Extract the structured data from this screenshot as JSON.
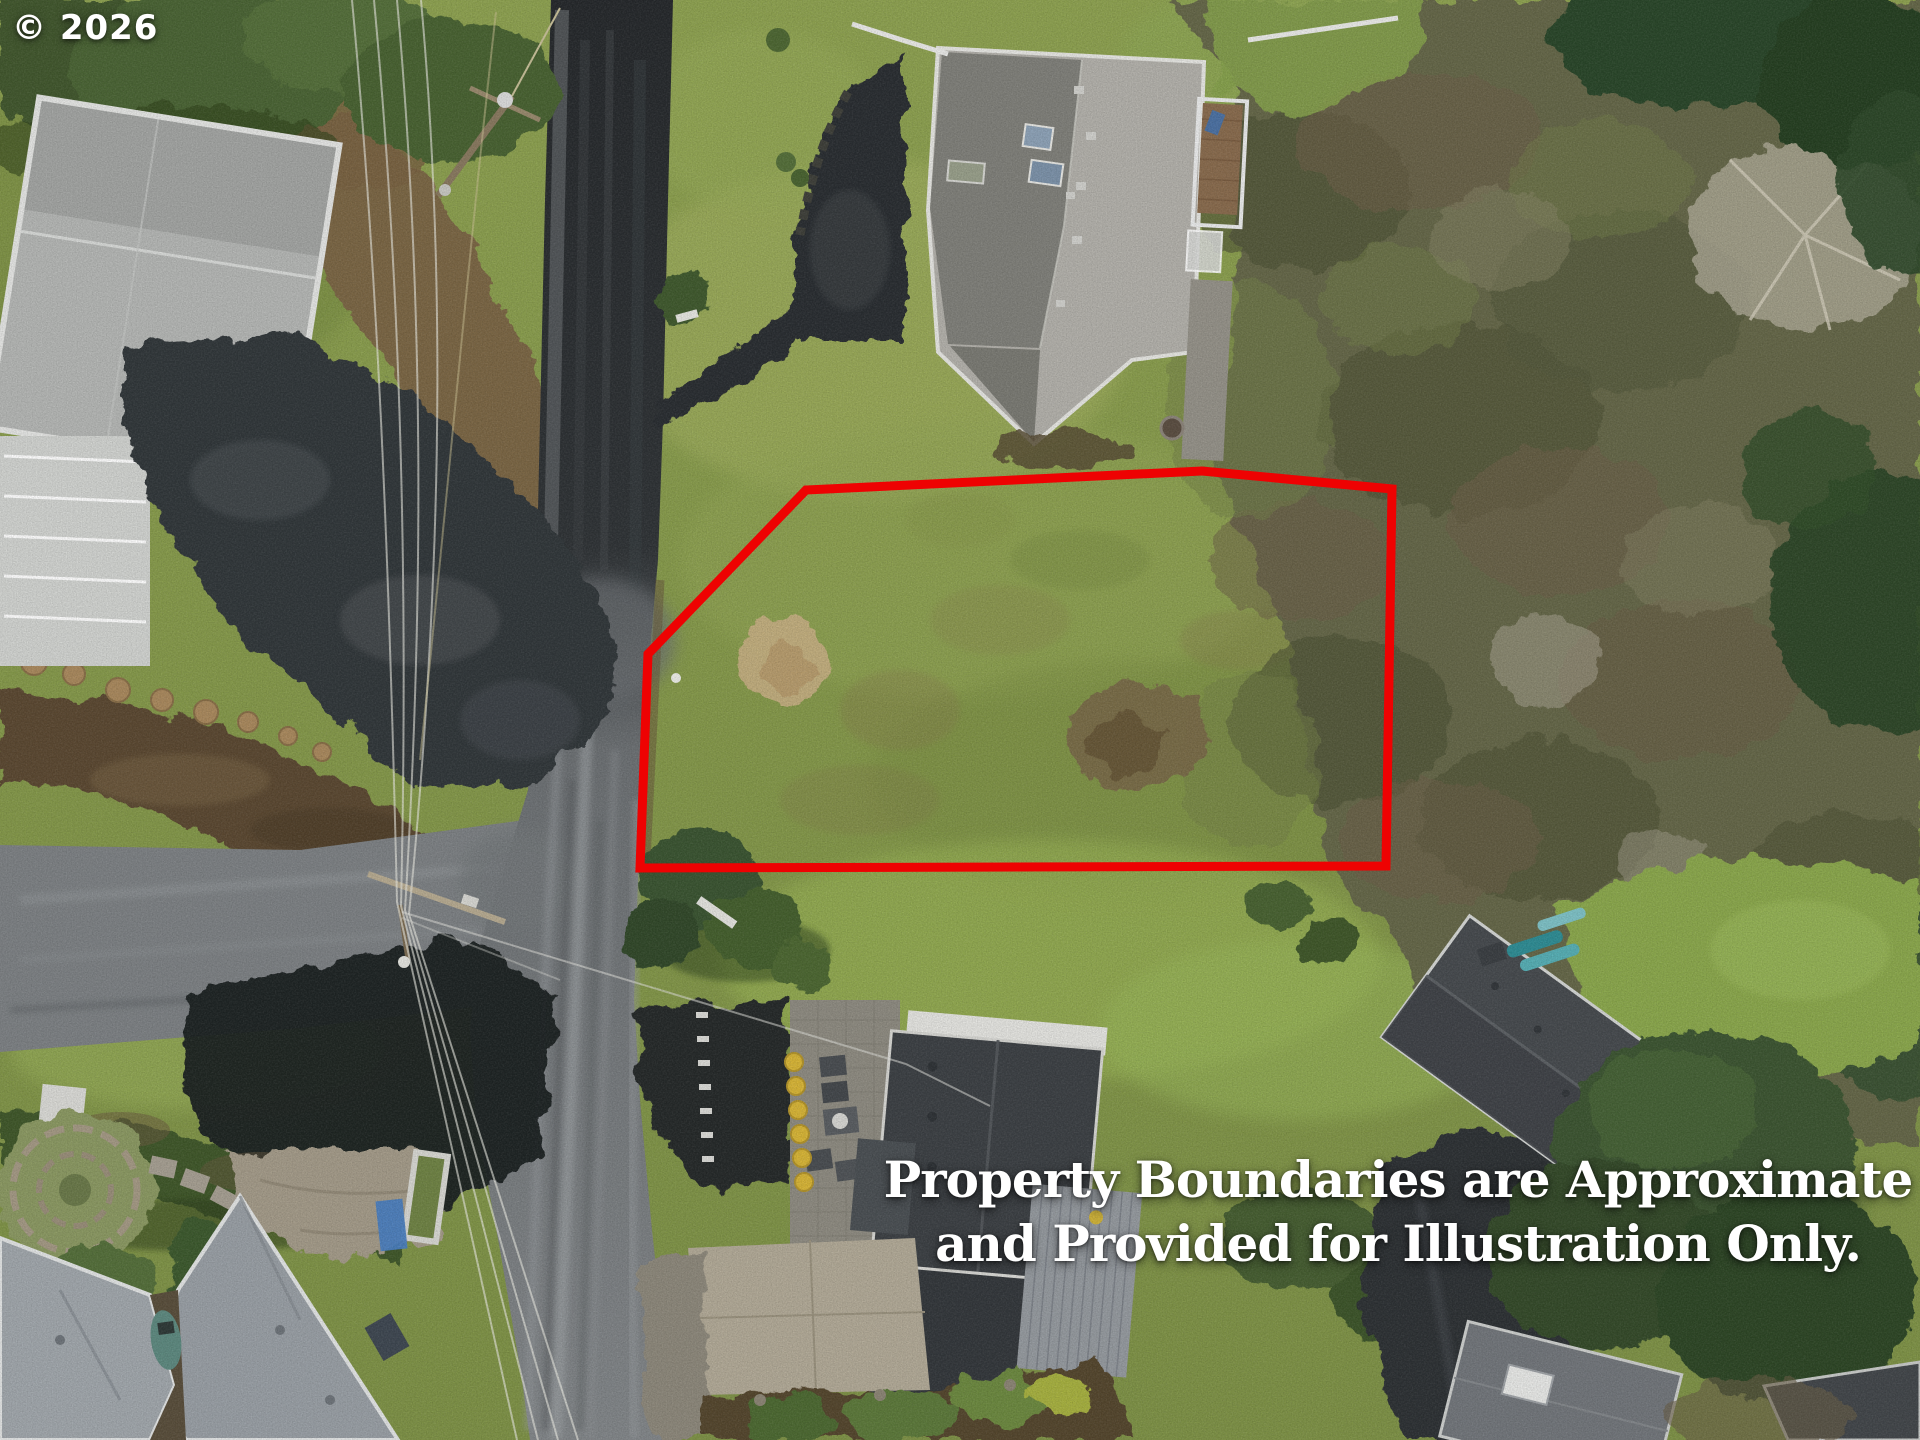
{
  "watermark": {
    "text": "© 2026"
  },
  "disclaimer": {
    "line1": "Property Boundaries are Approximate",
    "line2": "and Provided for Illustration Only."
  },
  "boundary": {
    "points_attr": "648,654 806,490 1202,471 1392,489 1386,866 640,868",
    "stroke_width": "9"
  },
  "colors": {
    "boundary_red": "#ee0202",
    "text_white": "#ffffff",
    "grass_base": "#8da24f",
    "road_fresh": "#2c2f32",
    "road_old": "#7d8184",
    "road_patch": "#1d2023",
    "roof_light": "#b6b8b6",
    "roof_mid": "#b4b2ac",
    "roof_dark": "#3d4145",
    "roof_bluegray": "#9aa0a6",
    "concrete": "#b3ab98",
    "dirt_brown": "#7b6544",
    "scrub_olive": "#66684a",
    "conifer_green": "#344c2b",
    "deck_wood": "#8a6c4e",
    "pot_yellow": "#d9b637",
    "tarp_blue": "#4a7fc1",
    "kayak_teal": "#57b0b6"
  }
}
